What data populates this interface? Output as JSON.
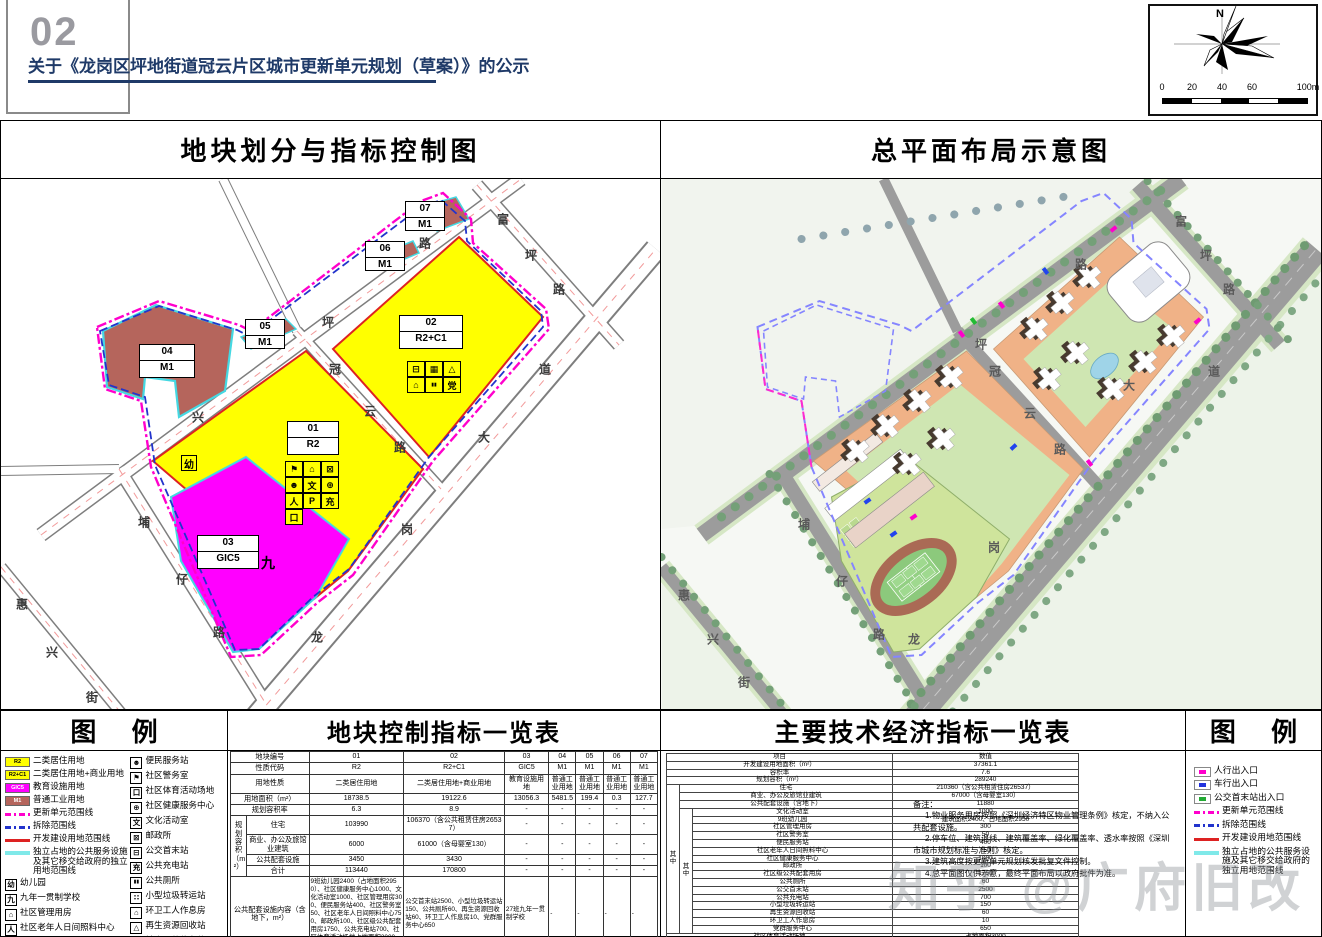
{
  "header": {
    "page_no": "02",
    "title": "关于《龙岗区坪地街道冠云片区城市更新单元规划（草案）》的公示",
    "compass_north": "N",
    "scale_ticks": [
      "0",
      "20",
      "40",
      "60"
    ],
    "scale_end": "100m"
  },
  "watermark": "知乎 @广府旧改",
  "colors": {
    "r2_yellow": "#ffff00",
    "gic5_magenta": "#ff00ff",
    "m1_brown": "#b5655c",
    "update_unit_line": "#ff00cc",
    "demolish_line": "#2233cc",
    "development_line": "#dd2222",
    "independent_land_line": "#7fe9e9",
    "title_navy": "#1f3a68"
  },
  "left_panel": {
    "title": "地块划分与指标控制图",
    "road_labels": [
      {
        "t": "兴",
        "x": 197,
        "y": 238
      },
      {
        "t": "坪",
        "x": 327,
        "y": 143
      },
      {
        "t": "路",
        "x": 424,
        "y": 64
      },
      {
        "t": "富",
        "x": 502,
        "y": 40
      },
      {
        "t": "坪",
        "x": 530,
        "y": 76
      },
      {
        "t": "路",
        "x": 558,
        "y": 110
      },
      {
        "t": "冠",
        "x": 334,
        "y": 190
      },
      {
        "t": "云",
        "x": 369,
        "y": 232
      },
      {
        "t": "路",
        "x": 399,
        "y": 268
      },
      {
        "t": "龙",
        "x": 316,
        "y": 458
      },
      {
        "t": "岗",
        "x": 406,
        "y": 350
      },
      {
        "t": "大",
        "x": 483,
        "y": 258
      },
      {
        "t": "道",
        "x": 544,
        "y": 190
      },
      {
        "t": "埔",
        "x": 143,
        "y": 343
      },
      {
        "t": "仔",
        "x": 181,
        "y": 400
      },
      {
        "t": "路",
        "x": 218,
        "y": 453
      },
      {
        "t": "惠",
        "x": 21,
        "y": 425
      },
      {
        "t": "兴",
        "x": 51,
        "y": 473
      },
      {
        "t": "街",
        "x": 91,
        "y": 518
      }
    ],
    "plot_labels": [
      {
        "id": "04",
        "code": "M1",
        "x": 138,
        "y": 165,
        "w": 56,
        "h": 34
      },
      {
        "id": "05",
        "code": "M1",
        "x": 244,
        "y": 140,
        "w": 40,
        "h": 30
      },
      {
        "id": "06",
        "code": "M1",
        "x": 364,
        "y": 62,
        "w": 40,
        "h": 30
      },
      {
        "id": "07",
        "code": "M1",
        "x": 404,
        "y": 22,
        "w": 40,
        "h": 30
      },
      {
        "id": "01",
        "code": "R2",
        "x": 286,
        "y": 242,
        "w": 52,
        "h": 34
      },
      {
        "id": "02",
        "code": "R2+C1",
        "x": 398,
        "y": 136,
        "w": 64,
        "h": 34
      },
      {
        "id": "03",
        "code": "GIC5",
        "x": 196,
        "y": 356,
        "w": 62,
        "h": 34
      }
    ],
    "markers": [
      {
        "t": "幼",
        "x": 180,
        "y": 276,
        "boxed": true,
        "name": "kindergarten-marker"
      },
      {
        "t": "九",
        "x": 260,
        "y": 374,
        "boxed": false,
        "name": "school-marker"
      }
    ],
    "icon_grids": [
      {
        "x": 284,
        "y": 282,
        "cols": 3,
        "cells": [
          {
            "g": "⚑",
            "n": "police-station-icon"
          },
          {
            "g": "⌂",
            "n": "community-mgmt-icon"
          },
          {
            "g": "⊠",
            "n": "post-office-icon"
          },
          {
            "g": "☻",
            "n": "convenience-station-icon"
          },
          {
            "g": "文",
            "n": "culture-room-icon"
          },
          {
            "g": "⊕",
            "n": "health-center-icon"
          },
          {
            "g": "人",
            "n": "elderly-care-icon"
          },
          {
            "g": "P",
            "n": "parking-icon"
          },
          {
            "g": "充",
            "n": "charging-icon"
          },
          {
            "g": "口",
            "n": "sports-ground-icon"
          }
        ]
      },
      {
        "x": 406,
        "y": 182,
        "cols": 3,
        "cells": [
          {
            "g": "⊟",
            "n": "bus-terminus-icon"
          },
          {
            "g": "▦",
            "n": "garbage-transfer-icon"
          },
          {
            "g": "△",
            "n": "recycling-icon"
          },
          {
            "g": "⌂",
            "n": "sanitation-room-icon"
          },
          {
            "g": "▮▮",
            "n": "toilet-icon"
          },
          {
            "g": "党",
            "n": "party-center-icon"
          }
        ]
      }
    ]
  },
  "right_panel": {
    "title": "总平面布局示意图",
    "road_labels": [
      {
        "t": "坪",
        "x": 320,
        "y": 165
      },
      {
        "t": "路",
        "x": 420,
        "y": 85
      },
      {
        "t": "富",
        "x": 520,
        "y": 42
      },
      {
        "t": "坪",
        "x": 545,
        "y": 76
      },
      {
        "t": "路",
        "x": 568,
        "y": 110
      },
      {
        "t": "冠",
        "x": 334,
        "y": 192
      },
      {
        "t": "云",
        "x": 369,
        "y": 234
      },
      {
        "t": "路",
        "x": 399,
        "y": 270
      },
      {
        "t": "龙",
        "x": 253,
        "y": 460
      },
      {
        "t": "岗",
        "x": 333,
        "y": 368
      },
      {
        "t": "大",
        "x": 468,
        "y": 206
      },
      {
        "t": "道",
        "x": 553,
        "y": 192
      },
      {
        "t": "埔",
        "x": 143,
        "y": 345
      },
      {
        "t": "仔",
        "x": 181,
        "y": 402
      },
      {
        "t": "路",
        "x": 218,
        "y": 455
      },
      {
        "t": "惠",
        "x": 23,
        "y": 416
      },
      {
        "t": "兴",
        "x": 52,
        "y": 460
      },
      {
        "t": "街",
        "x": 83,
        "y": 503
      }
    ]
  },
  "legend_left": {
    "title": "图  例",
    "col1": [
      {
        "type": "area",
        "color": "#ffff00",
        "dark": false,
        "code": "R2",
        "label": "二类居住用地",
        "name": "r2-area-chip"
      },
      {
        "type": "area",
        "color": "#ffff00",
        "dark": false,
        "code": "R2+C1",
        "label": "二类居住用地+商业用地",
        "name": "r2c1-area-chip"
      },
      {
        "type": "area",
        "color": "#ff00ff",
        "dark": true,
        "code": "GIC5",
        "label": "教育设施用地",
        "name": "gic5-area-chip"
      },
      {
        "type": "area",
        "color": "#b5655c",
        "dark": true,
        "code": "M1",
        "label": "普通工业用地",
        "name": "m1-area-chip"
      },
      {
        "type": "line",
        "style": "update",
        "label": "更新单元范围线",
        "name": "update-unit-line-chip"
      },
      {
        "type": "line",
        "style": "demolish",
        "label": "拆除范围线",
        "name": "demolish-line-chip"
      },
      {
        "type": "line",
        "style": "develop",
        "label": "开发建设用地范围线",
        "name": "development-line-chip"
      },
      {
        "type": "line",
        "style": "independent",
        "label": "独立占地的公共服务设施及其它移交给政府的独立用地范围线",
        "name": "independent-land-line-chip"
      },
      {
        "type": "box",
        "glyph": "幼",
        "label": "幼儿园",
        "name": "kindergarten-icon"
      },
      {
        "type": "box",
        "glyph": "九",
        "label": "九年一贯制学校",
        "name": "nine-year-school-icon"
      },
      {
        "type": "box",
        "glyph": "⌂",
        "label": "社区管理用房",
        "name": "community-mgmt-icon"
      },
      {
        "type": "box",
        "glyph": "人",
        "label": "社区老年人日间照料中心",
        "name": "elderly-care-icon"
      },
      {
        "type": "stack",
        "top": "01",
        "bottom": "R2",
        "label_top": "地块编号",
        "label_bottom": "用地性质",
        "name": "plot-id-chip"
      }
    ],
    "col2": [
      {
        "type": "box",
        "glyph": "☻",
        "label": "便民服务站",
        "name": "convenience-station-icon"
      },
      {
        "type": "box",
        "glyph": "⚑",
        "label": "社区警务室",
        "name": "police-station-icon"
      },
      {
        "type": "box",
        "glyph": "口",
        "label": "社区体育活动场地",
        "name": "sports-ground-icon"
      },
      {
        "type": "box",
        "glyph": "⊕",
        "label": "社区健康服务中心",
        "name": "health-center-icon"
      },
      {
        "type": "box",
        "glyph": "文",
        "label": "文化活动室",
        "name": "culture-room-icon"
      },
      {
        "type": "box",
        "glyph": "⊠",
        "label": "邮政所",
        "name": "post-office-icon"
      },
      {
        "type": "box",
        "glyph": "⊟",
        "label": "公交首末站",
        "name": "bus-terminus-icon"
      },
      {
        "type": "box",
        "glyph": "充",
        "label": "公共充电站",
        "name": "charging-icon"
      },
      {
        "type": "box",
        "glyph": "▮▮",
        "label": "公共厕所",
        "name": "toilet-icon"
      },
      {
        "type": "box",
        "glyph": "∷",
        "label": "小型垃圾转运站",
        "name": "garbage-transfer-icon"
      },
      {
        "type": "box",
        "glyph": "⌂",
        "label": "环卫工人作息房",
        "name": "sanitation-room-icon"
      },
      {
        "type": "box",
        "glyph": "△",
        "label": "再生资源回收站",
        "name": "recycling-icon"
      },
      {
        "type": "box",
        "glyph": "P",
        "label": "社会公共停车位",
        "name": "parking-icon"
      },
      {
        "type": "box",
        "glyph": "党",
        "label": "党群服务中心",
        "name": "party-center-icon"
      }
    ]
  },
  "plot_table": {
    "title": "地块控制指标一览表",
    "simple_rows": [
      {
        "label": "地块编号",
        "values": [
          "01",
          "02",
          "03",
          "04",
          "05",
          "06",
          "07"
        ]
      },
      {
        "label": "性质代码",
        "values": [
          "R2",
          "R2+C1",
          "GIC5",
          "M1",
          "M1",
          "M1",
          "M1"
        ]
      },
      {
        "label": "用地性质",
        "values": [
          "二类居住用地",
          "二类居住用地+商业用地",
          "教育设施用地",
          "普通工业用地",
          "普通工业用地",
          "普通工业用地",
          "普通工业用地"
        ]
      },
      {
        "label": "用地面积（m²）",
        "values": [
          "18738.5",
          "19122.6",
          "13056.3",
          "5481.5",
          "199.4",
          "0.3",
          "127.7"
        ]
      },
      {
        "label": "规划容积率",
        "values": [
          "6.3",
          "8.9",
          "-",
          "-",
          "-",
          "-",
          "-"
        ]
      }
    ],
    "volume_group": {
      "label": "规划容积（m²）",
      "rows": [
        {
          "label": "住宅",
          "values": [
            "103990",
            "106370（含公共租赁住房26537）",
            "-",
            "-",
            "-",
            "-",
            "-"
          ]
        },
        {
          "label": "商业、办公及旅馆业建筑",
          "values": [
            "6000",
            "61000（含母婴室130）",
            "-",
            "-",
            "-",
            "-",
            "-"
          ]
        },
        {
          "label": "公共配套设施",
          "values": [
            "3450",
            "3430",
            "-",
            "-",
            "-",
            "-",
            "-"
          ]
        },
        {
          "label": "合计",
          "values": [
            "113440",
            "170800",
            "-",
            "-",
            "-",
            "-",
            "-"
          ]
        }
      ]
    },
    "tail_rows": [
      {
        "label": "公共配套设施内容（含地下，m²）",
        "tall": true,
        "values": [
          "9班幼儿园2400（占地面积2950）、社区健康服务中心1000、文化活动室1000、社区管理用房300、便民服务站400、社区警务室50、社区老年人日间照料中心750、邮政所100、社区级公共配套用房1750、公共充电站700、社区体育活动场地占地面积3000、社会公共停车位100个",
          "公交首末站2500、小型垃圾转运站150、公共厕所60、再生资源回收站60、环卫工人作息房10、党群服务中心650",
          "27班九年一贯制学校",
          "-",
          "-",
          "-",
          "-"
        ]
      },
      {
        "label": "年径流总量控制率（%）",
        "values": [
          "66",
          "66",
          "67",
          "65",
          "-",
          "-",
          "-"
        ]
      },
      {
        "label": "备注",
        "values": [
          "拆除重建",
          "拆除重建",
          "拆除重建",
          "拆除重建",
          "拆除重建",
          "拆除重建",
          "拆除重建"
        ]
      }
    ]
  },
  "econ_table": {
    "title": "主要技术经济指标一览表",
    "head": {
      "label": "项目",
      "value": "数值"
    },
    "top_rows": [
      {
        "label": "开发建设用地面积（m²）",
        "value": "37361.1"
      },
      {
        "label": "容积率",
        "value": "7.6"
      },
      {
        "label": "规划容积（m²）",
        "value": "289240"
      }
    ],
    "among1_label": "其中",
    "among1_rows": [
      {
        "label": "住宅",
        "value": "210360（含公共租赁住房26537）"
      },
      {
        "label": "商业、办公及旅馆业建筑",
        "value": "67000（含母婴室130）"
      },
      {
        "label": "公共配套设施（含地下）",
        "value": "11880"
      }
    ],
    "among2_label": "其中",
    "among2_rows": [
      {
        "label": "文化活动室",
        "value": "1000"
      },
      {
        "label": "9班幼儿园",
        "value": "建筑面积2400、占地面积2950"
      },
      {
        "label": "社区管理用房",
        "value": "300"
      },
      {
        "label": "社区警务室",
        "value": "50"
      },
      {
        "label": "便民服务站",
        "value": "400"
      },
      {
        "label": "社区老年人日间照料中心",
        "value": "750"
      },
      {
        "label": "社区健康服务中心",
        "value": "1000"
      },
      {
        "label": "邮政所",
        "value": "100"
      },
      {
        "label": "社区级公共配套用房",
        "value": "1750"
      },
      {
        "label": "公共厕所",
        "value": "60"
      },
      {
        "label": "公交首末站",
        "value": "2500"
      },
      {
        "label": "公共充电站",
        "value": "700"
      },
      {
        "label": "小型垃圾转运站",
        "value": "150"
      },
      {
        "label": "再生资源回收站",
        "value": "60"
      },
      {
        "label": "环卫工人作息房",
        "value": "10"
      },
      {
        "label": "党群服务中心",
        "value": "650"
      }
    ],
    "bottom_rows": [
      {
        "label": "社区体育活动场地",
        "value": "占地面积3000"
      },
      {
        "label": "社会公共停车位",
        "value": "100个"
      }
    ],
    "notes_title": "备注：",
    "notes": [
      "1.物业服务用房按照《深圳经济特区物业管理条例》核定，不纳入公共配套设施。",
      "2.停车位、建筑退线、建筑覆盖率、绿化覆盖率、透水率按照《深圳市城市规划标准与准则》核定。",
      "3.建筑高度按更新单元规划核发批复文件控制。",
      "4.总平面图仅供示意，最终平面布局以政府批件为准。"
    ]
  },
  "legend_right": {
    "title": "图  例",
    "items": [
      {
        "type": "entrance",
        "color": "#ff00cc",
        "label": "人行出入口",
        "name": "pedestrian-entrance-icon"
      },
      {
        "type": "entrance",
        "color": "#2233dd",
        "label": "车行出入口",
        "name": "vehicle-entrance-icon"
      },
      {
        "type": "entrance",
        "color": "#22aa33",
        "label": "公交首末站出入口",
        "name": "bus-entrance-icon"
      },
      {
        "type": "line",
        "style": "update",
        "label": "更新单元范围线",
        "name": "update-unit-line-chip"
      },
      {
        "type": "line",
        "style": "demolish",
        "label": "拆除范围线",
        "name": "demolish-line-chip"
      },
      {
        "type": "line",
        "style": "develop",
        "label": "开发建设用地范围线",
        "name": "development-line-chip"
      },
      {
        "type": "line",
        "style": "independent",
        "label": "独立占地的公共服务设施及其它移交给政府的独立用地范围线",
        "name": "independent-land-line-chip"
      }
    ]
  }
}
